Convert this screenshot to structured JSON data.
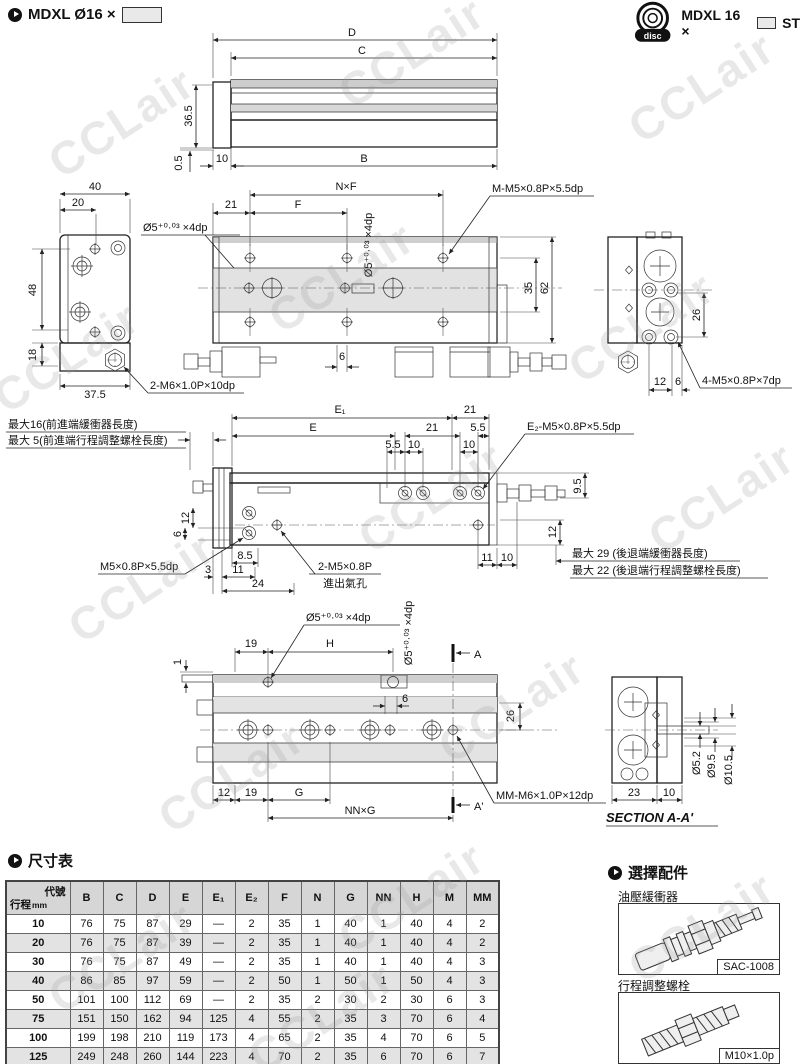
{
  "watermark": "CCLair",
  "header": {
    "left_model": "MDXL Ø16 ×",
    "right_model_prefix": "MDXL 16 ×",
    "right_model_suffix": "ST",
    "logo_text": "disc"
  },
  "d1": {
    "D": "D",
    "C": "C",
    "B": "B",
    "v365": "36.5",
    "v05": "0.5",
    "n10": "10"
  },
  "d2": {
    "w40": "40",
    "w20": "20",
    "h48": "48",
    "h18": "18",
    "w375": "37.5",
    "hole_label": "Ø5⁺⁰·⁰³ ×4dp",
    "thread2m6": "2-M6×1.0P×10dp",
    "nxf": "N×F",
    "n21": "21",
    "F": "F",
    "hole_label_v": "Ø5⁺⁰·⁰³ ×4dp",
    "m_label": "M-M5×0.8P×5.5dp",
    "n35": "35",
    "n62": "62",
    "n6": "6",
    "n26": "26",
    "thread4m5": "4-M5×0.8P×7dp",
    "n12": "12",
    "n6b": "6"
  },
  "d3": {
    "E1": "E₁",
    "E": "E",
    "n21a": "21",
    "n21b": "21",
    "n55a": "5.5",
    "n55b": "5.5",
    "n10a": "10",
    "n10b": "10",
    "e2_label": "E₂-M5×0.8P×5.5dp",
    "max16": "最大16(前進端緩衝器長度)",
    "max5": "最大 5(前進端行程調整螺栓長度)",
    "max29": "最大 29 (後退端緩衝器長度)",
    "max22": "最大 22 (後退端行程調整螺栓長度)",
    "m5_label": "M5×0.8P×5.5dp",
    "port_thread": "2-M5×0.8P",
    "port_name": "進出氣孔",
    "n85": "8.5",
    "n3": "3",
    "n11": "11",
    "n24": "24",
    "n11r": "11",
    "n10r": "10",
    "v12l": "12",
    "v6l": "6",
    "v12r": "12",
    "v95": "9.5"
  },
  "d4": {
    "hole_label": "Ø5⁺⁰·⁰³ ×4dp",
    "hole_label_v": "Ø5⁺⁰·⁰³ ×4dp",
    "n19": "19",
    "H": "H",
    "n1": "1",
    "n6": "6",
    "n26": "26",
    "A": "A",
    "A2": "A'",
    "n12": "12",
    "n19b": "19",
    "G": "G",
    "nng": "NN×G",
    "mm_label": "MM-M6×1.0P×12dp"
  },
  "sec": {
    "n23": "23",
    "n10": "10",
    "d52": "Ø5.2",
    "d95": "Ø9.5",
    "d105": "Ø10.5",
    "title": "SECTION A-A'"
  },
  "table": {
    "title": "尺寸表",
    "corner_top": "代號",
    "corner_bottom": "行程",
    "corner_unit": "mm",
    "headers": [
      "B",
      "C",
      "D",
      "E",
      "E₁",
      "E₂",
      "F",
      "N",
      "G",
      "NN",
      "H",
      "M",
      "MM"
    ],
    "rows": [
      {
        "stroke": "10",
        "values": [
          "76",
          "75",
          "87",
          "29",
          "—",
          "2",
          "35",
          "1",
          "40",
          "1",
          "40",
          "4",
          "2"
        ]
      },
      {
        "stroke": "20",
        "values": [
          "76",
          "75",
          "87",
          "39",
          "—",
          "2",
          "35",
          "1",
          "40",
          "1",
          "40",
          "4",
          "2"
        ]
      },
      {
        "stroke": "30",
        "values": [
          "76",
          "75",
          "87",
          "49",
          "—",
          "2",
          "35",
          "1",
          "40",
          "1",
          "40",
          "4",
          "3"
        ]
      },
      {
        "stroke": "40",
        "values": [
          "86",
          "85",
          "97",
          "59",
          "—",
          "2",
          "50",
          "1",
          "50",
          "1",
          "50",
          "4",
          "3"
        ]
      },
      {
        "stroke": "50",
        "values": [
          "101",
          "100",
          "112",
          "69",
          "—",
          "2",
          "35",
          "2",
          "30",
          "2",
          "30",
          "6",
          "3"
        ]
      },
      {
        "stroke": "75",
        "values": [
          "151",
          "150",
          "162",
          "94",
          "125",
          "4",
          "55",
          "2",
          "35",
          "3",
          "70",
          "6",
          "4"
        ]
      },
      {
        "stroke": "100",
        "values": [
          "199",
          "198",
          "210",
          "119",
          "173",
          "4",
          "65",
          "2",
          "35",
          "4",
          "70",
          "6",
          "5"
        ]
      },
      {
        "stroke": "125",
        "values": [
          "249",
          "248",
          "260",
          "144",
          "223",
          "4",
          "70",
          "2",
          "35",
          "6",
          "70",
          "6",
          "7"
        ]
      }
    ]
  },
  "accessories": {
    "title": "選擇配件",
    "item1_label": "油壓緩衝器",
    "item1_model": "SAC-1008",
    "item2_label": "行程調整螺栓",
    "item2_model": "M10×1.0p"
  }
}
